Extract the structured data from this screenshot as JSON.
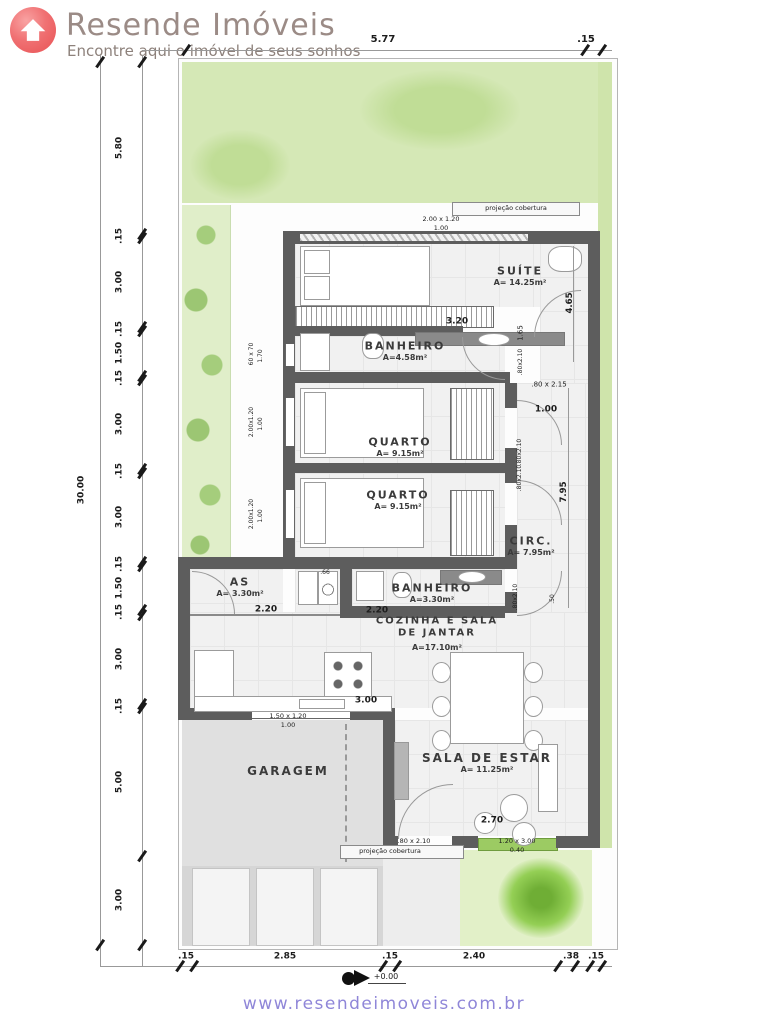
{
  "header": {
    "title": "Resende Imóveis",
    "tagline": "Encontre aqui o imóvel de seus sonhos"
  },
  "footer": {
    "url": "www.resendeimoveis.com.br"
  },
  "colors": {
    "logo_red": "#f07173",
    "brand_text": "#9b8b86",
    "footer_link": "#8f86d8",
    "garden_green": "#d5e8b6",
    "wall_gray": "#5d5d5d"
  },
  "plan": {
    "rooms": [
      {
        "name": "SUÍTE",
        "area": "A= 14.25m²",
        "x": 520,
        "y": 272
      },
      {
        "name": "BANHEIRO",
        "area": "A=4.58m²",
        "x": 405,
        "y": 347
      },
      {
        "name": "QUARTO",
        "area": "A= 9.15m²",
        "x": 400,
        "y": 443
      },
      {
        "name": "QUARTO",
        "area": "A= 9.15m²",
        "x": 398,
        "y": 496
      },
      {
        "name": "CIRC.",
        "area": "A= 7.95m²",
        "x": 531,
        "y": 542
      },
      {
        "name": "AS",
        "area": "A= 3.30m²",
        "x": 240,
        "y": 583
      },
      {
        "name": "BANHEIRO",
        "area": "A=3.30m²",
        "x": 432,
        "y": 589
      },
      {
        "name": "COZINHA E SALA\nDE JANTAR",
        "area": "A=17.10m²",
        "x": 437,
        "y": 627,
        "s": 10
      },
      {
        "name": "GARAGEM",
        "area": "",
        "x": 288,
        "y": 772,
        "s": 12
      },
      {
        "name": "SALA DE ESTAR",
        "area": "A= 11.25m²",
        "x": 487,
        "y": 759,
        "s": 12
      }
    ],
    "dim_labels": [
      {
        "t": "5.77",
        "x": 383,
        "y": 40,
        "s": 10,
        "b": 1
      },
      {
        "t": ".15",
        "x": 586,
        "y": 40,
        "s": 10,
        "b": 1
      },
      {
        "t": "30.00",
        "x": 82,
        "y": 490,
        "s": 9,
        "b": 1,
        "r": -90
      },
      {
        "t": "5.80",
        "x": 120,
        "y": 148,
        "s": 9,
        "b": 1,
        "r": -90
      },
      {
        "t": ".15",
        "x": 120,
        "y": 236,
        "s": 9,
        "b": 1,
        "r": -90
      },
      {
        "t": "3.00",
        "x": 120,
        "y": 282,
        "s": 9,
        "b": 1,
        "r": -90
      },
      {
        "t": ".15",
        "x": 120,
        "y": 329,
        "s": 9,
        "b": 1,
        "r": -90
      },
      {
        "t": "1.50",
        "x": 120,
        "y": 353,
        "s": 9,
        "b": 1,
        "r": -90
      },
      {
        "t": ".15",
        "x": 120,
        "y": 378,
        "s": 9,
        "b": 1,
        "r": -90
      },
      {
        "t": "3.00",
        "x": 120,
        "y": 424,
        "s": 9,
        "b": 1,
        "r": -90
      },
      {
        "t": ".15",
        "x": 120,
        "y": 471,
        "s": 9,
        "b": 1,
        "r": -90
      },
      {
        "t": "3.00",
        "x": 120,
        "y": 517,
        "s": 9,
        "b": 1,
        "r": -90
      },
      {
        "t": ".15",
        "x": 120,
        "y": 564,
        "s": 9,
        "b": 1,
        "r": -90
      },
      {
        "t": "1.50",
        "x": 120,
        "y": 588,
        "s": 9,
        "b": 1,
        "r": -90
      },
      {
        "t": ".15",
        "x": 120,
        "y": 612,
        "s": 9,
        "b": 1,
        "r": -90
      },
      {
        "t": "3.00",
        "x": 120,
        "y": 659,
        "s": 9,
        "b": 1,
        "r": -90
      },
      {
        "t": ".15",
        "x": 120,
        "y": 706,
        "s": 9,
        "b": 1,
        "r": -90
      },
      {
        "t": "5.00",
        "x": 120,
        "y": 782,
        "s": 9,
        "b": 1,
        "r": -90
      },
      {
        "t": "3.00",
        "x": 120,
        "y": 900,
        "s": 9,
        "b": 1,
        "r": -90
      },
      {
        "t": ".15",
        "x": 186,
        "y": 957,
        "s": 9,
        "b": 1
      },
      {
        "t": "2.85",
        "x": 285,
        "y": 957,
        "s": 9,
        "b": 1
      },
      {
        "t": ".15",
        "x": 390,
        "y": 957,
        "s": 9,
        "b": 1
      },
      {
        "t": "2.40",
        "x": 474,
        "y": 957,
        "s": 9,
        "b": 1
      },
      {
        "t": ".38",
        "x": 571,
        "y": 957,
        "s": 9,
        "b": 1
      },
      {
        "t": ".15",
        "x": 596,
        "y": 957,
        "s": 9,
        "b": 1
      }
    ],
    "annotations": [
      {
        "t": "projeção cobertura",
        "x": 516,
        "y": 208,
        "s": 6.5
      },
      {
        "t": "2.00 x 1.20",
        "x": 441,
        "y": 219,
        "s": 6.5
      },
      {
        "t": "1.00",
        "x": 441,
        "y": 228,
        "s": 6.5
      },
      {
        "t": "3.20",
        "x": 457,
        "y": 322,
        "s": 9,
        "b": 1
      },
      {
        "t": "4.65",
        "x": 570,
        "y": 303,
        "s": 8.5,
        "b": 1,
        "r": -90
      },
      {
        "t": "1.65",
        "x": 521,
        "y": 333,
        "s": 7,
        "r": -90
      },
      {
        "t": ".80x2.10",
        "x": 521,
        "y": 362,
        "s": 6,
        "r": -90
      },
      {
        "t": "60 x 70",
        "x": 252,
        "y": 354,
        "s": 6,
        "r": -90
      },
      {
        "t": "1.70",
        "x": 261,
        "y": 356,
        "s": 6,
        "r": -90
      },
      {
        "t": ".80 x 2.15",
        "x": 549,
        "y": 385,
        "s": 7
      },
      {
        "t": "1.00",
        "x": 546,
        "y": 410,
        "s": 9,
        "b": 1
      },
      {
        "t": "2.00x1.20",
        "x": 252,
        "y": 422,
        "s": 6,
        "r": -90
      },
      {
        "t": "1.00",
        "x": 261,
        "y": 424,
        "s": 6,
        "r": -90
      },
      {
        "t": ".80x2.10",
        "x": 520,
        "y": 452,
        "s": 6,
        "r": -90
      },
      {
        "t": ".80x2.10",
        "x": 520,
        "y": 478,
        "s": 6,
        "r": -90
      },
      {
        "t": "2.00x1.20",
        "x": 252,
        "y": 514,
        "s": 6,
        "r": -90
      },
      {
        "t": "1.00",
        "x": 261,
        "y": 516,
        "s": 6,
        "r": -90
      },
      {
        "t": "7.95",
        "x": 564,
        "y": 492,
        "s": 8.5,
        "b": 1,
        "r": -90
      },
      {
        "t": ".80x2.10",
        "x": 516,
        "y": 597,
        "s": 6,
        "r": -90
      },
      {
        "t": ".66",
        "x": 325,
        "y": 573,
        "s": 6
      },
      {
        "t": ".50",
        "x": 553,
        "y": 599,
        "s": 6,
        "r": -90
      },
      {
        "t": "2.20",
        "x": 266,
        "y": 610,
        "s": 9,
        "b": 1
      },
      {
        "t": "2.20",
        "x": 377,
        "y": 611,
        "s": 9,
        "b": 1
      },
      {
        "t": "3.00",
        "x": 366,
        "y": 701,
        "s": 9,
        "b": 1
      },
      {
        "t": "1.50 x 1.20",
        "x": 288,
        "y": 716,
        "s": 6.5
      },
      {
        "t": "1.00",
        "x": 288,
        "y": 725,
        "s": 6.5
      },
      {
        "t": "2.70",
        "x": 492,
        "y": 821,
        "s": 9,
        "b": 1
      },
      {
        "t": ".80 x 2.10",
        "x": 414,
        "y": 841,
        "s": 6.5
      },
      {
        "t": "projeção cobertura",
        "x": 390,
        "y": 851,
        "s": 6.5
      },
      {
        "t": "1.20 x 3.00",
        "x": 517,
        "y": 841,
        "s": 6.5
      },
      {
        "t": "0.40",
        "x": 517,
        "y": 850,
        "s": 6.5
      },
      {
        "t": "+0.00",
        "x": 386,
        "y": 977,
        "s": 8
      }
    ],
    "ticks": [
      {
        "x": 186,
        "y": 50
      },
      {
        "x": 585,
        "y": 50
      },
      {
        "x": 602,
        "y": 50
      },
      {
        "x": 100,
        "y": 62
      },
      {
        "x": 100,
        "y": 945
      },
      {
        "x": 142,
        "y": 62
      },
      {
        "x": 142,
        "y": 234
      },
      {
        "x": 142,
        "y": 238
      },
      {
        "x": 142,
        "y": 327
      },
      {
        "x": 142,
        "y": 331
      },
      {
        "x": 142,
        "y": 376
      },
      {
        "x": 142,
        "y": 380
      },
      {
        "x": 142,
        "y": 469
      },
      {
        "x": 142,
        "y": 473
      },
      {
        "x": 142,
        "y": 562
      },
      {
        "x": 142,
        "y": 566
      },
      {
        "x": 142,
        "y": 610
      },
      {
        "x": 142,
        "y": 615
      },
      {
        "x": 142,
        "y": 704
      },
      {
        "x": 142,
        "y": 708
      },
      {
        "x": 142,
        "y": 856
      },
      {
        "x": 142,
        "y": 945
      },
      {
        "x": 180,
        "y": 966
      },
      {
        "x": 194,
        "y": 966
      },
      {
        "x": 383,
        "y": 966
      },
      {
        "x": 397,
        "y": 966
      },
      {
        "x": 558,
        "y": 966
      },
      {
        "x": 575,
        "y": 966
      },
      {
        "x": 590,
        "y": 966
      },
      {
        "x": 602,
        "y": 966
      }
    ]
  }
}
